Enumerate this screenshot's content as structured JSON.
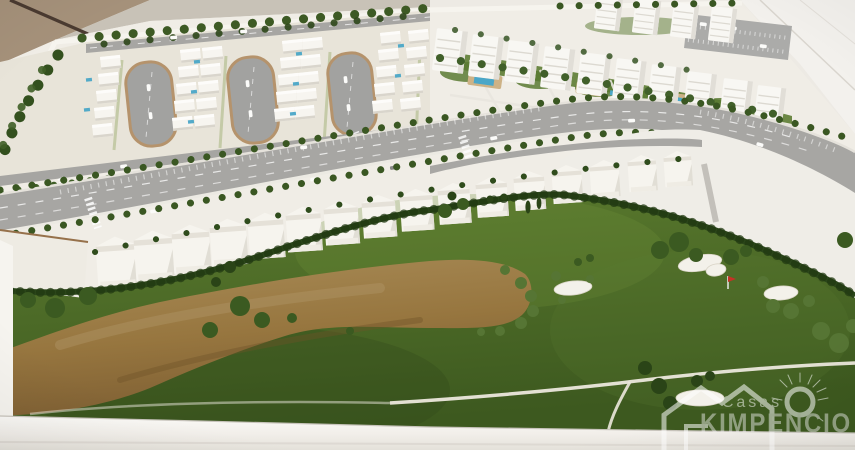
{
  "watermark": {
    "brand_line1": "Casas",
    "brand_line2": "KIMPENCIO"
  },
  "palette": {
    "wall_tan": "#a5917a",
    "table_white": "#edeae4",
    "model_base": "#f0ede6",
    "zone_ground": "#e8e4d9",
    "road_grey": "#a7a6a3",
    "curb_tan": "#b5936c",
    "golf_green_dark": "#3f5c20",
    "golf_green_mid": "#557430",
    "hedge_green": "#2b461a",
    "tree_green": "#3b5a21",
    "sand_brown": "#97763f",
    "pool_blue": "#4ba7c8",
    "building_white": "#f7f5f0",
    "flag_red": "#c63226",
    "watermark_white": "#ffffff"
  }
}
